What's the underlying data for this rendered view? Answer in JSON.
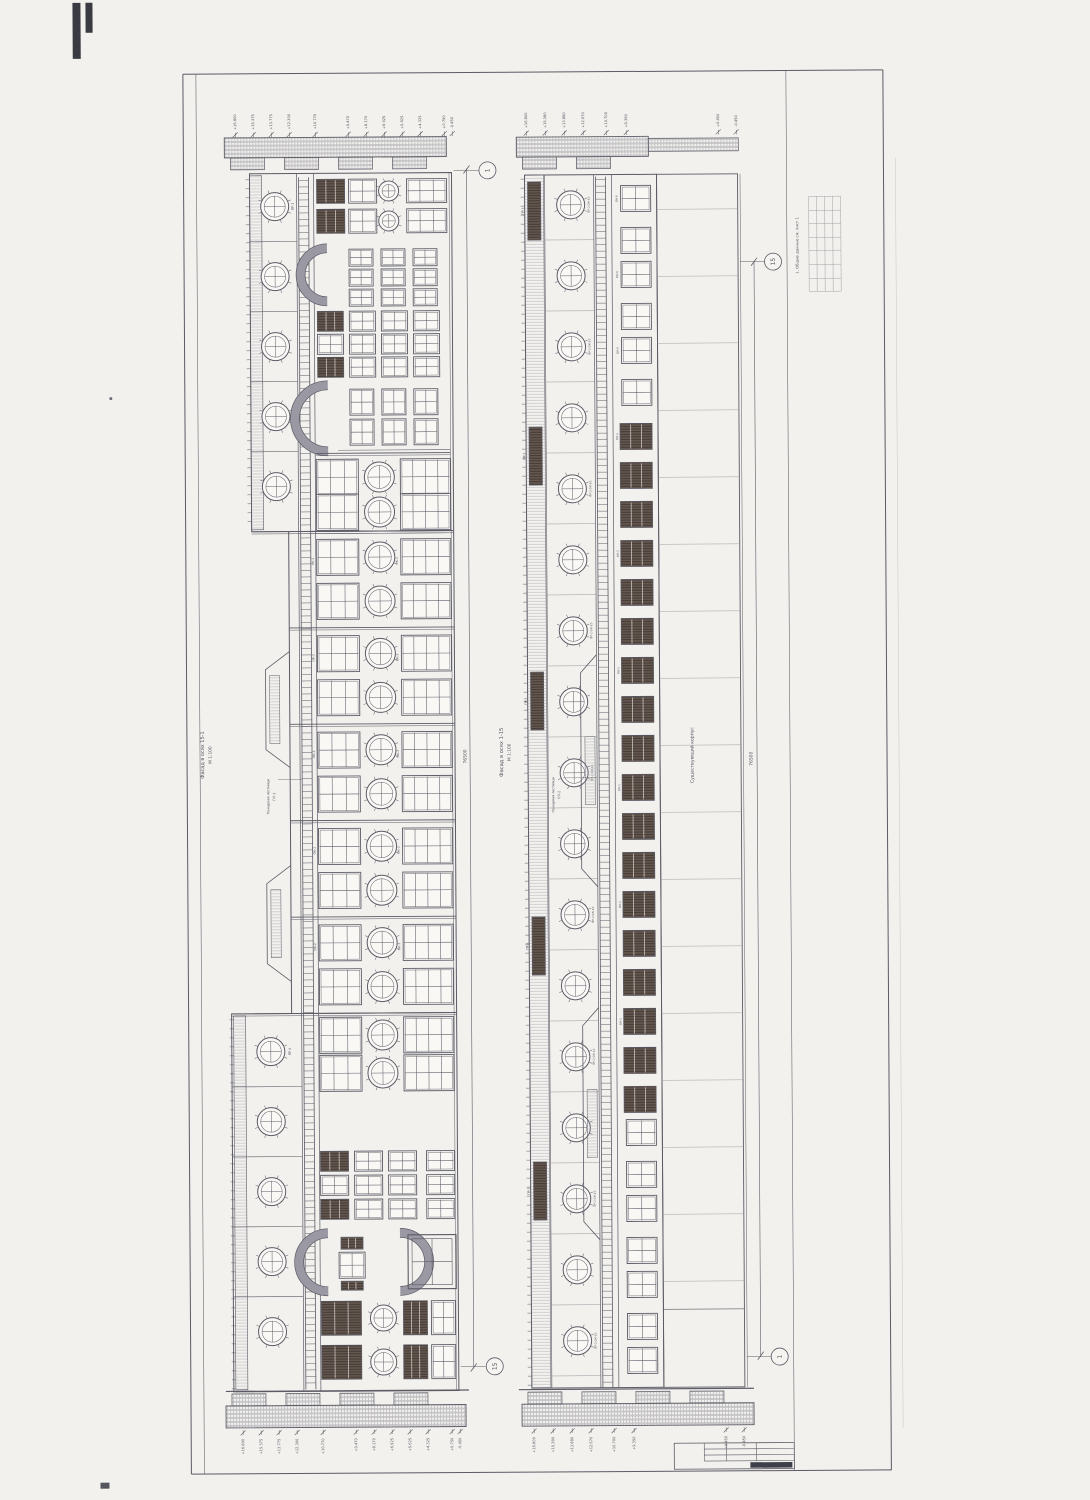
{
  "labels": {
    "left_title_1": "Фасад в осях 15-1",
    "left_title_2": "М 1:100",
    "center_title_1": "Фасад в осях 1-15",
    "center_title_2": "М 1:100",
    "right_wing": "Существующий корпус",
    "note": "1. Общие данные см. лист 1",
    "ladder_text": "Пожарная лестница",
    "ladder1": "ПЛ-1",
    "ladder2": "ПЛ-2"
  },
  "bubbles": {
    "left_top": "1",
    "left_bottom": "15",
    "right_top": "15",
    "right_bottom": "1"
  },
  "dims": {
    "center_total": "76500",
    "right_total": "76500"
  },
  "marks": {
    "left_top": [
      "+16.800",
      "+15.375",
      "+13.775",
      "+12.300",
      "+10.770",
      "+9.470",
      "+8.170",
      "+6.925",
      "+5.625",
      "+4.325",
      "+0.750",
      "-0.450"
    ],
    "left_bottom": [
      "+16.800",
      "+15.375",
      "+13.775",
      "+12.300",
      "+10.770",
      "+9.470",
      "+8.170",
      "+6.925",
      "+5.625",
      "+4.325",
      "+0.750",
      "-0.450"
    ],
    "right_top": [
      "+16.800",
      "+15.380",
      "+13.880",
      "+12.670",
      "+10.700",
      "+9.350",
      "+0.450",
      "-0.450"
    ],
    "right_bottom": [
      "+16.800",
      "+15.380",
      "+13.880",
      "+12.670",
      "+10.700",
      "+9.350",
      "+0.450",
      "-0.450"
    ]
  },
  "tags": {
    "round_upper": "ПР-1",
    "round_lower": "ПР-4",
    "round_right": "ПР-2 ОК-10",
    "dark": "ОК-1",
    "pair_small": "ОК-6",
    "rect": "ОК-2",
    "wide": "ОК-3",
    "slot": "ПР-3"
  },
  "colors": {
    "ink": "#5c5b66",
    "light": "#9a98a2",
    "dark_fill": "#645850",
    "paper": "#f5f4f0"
  }
}
